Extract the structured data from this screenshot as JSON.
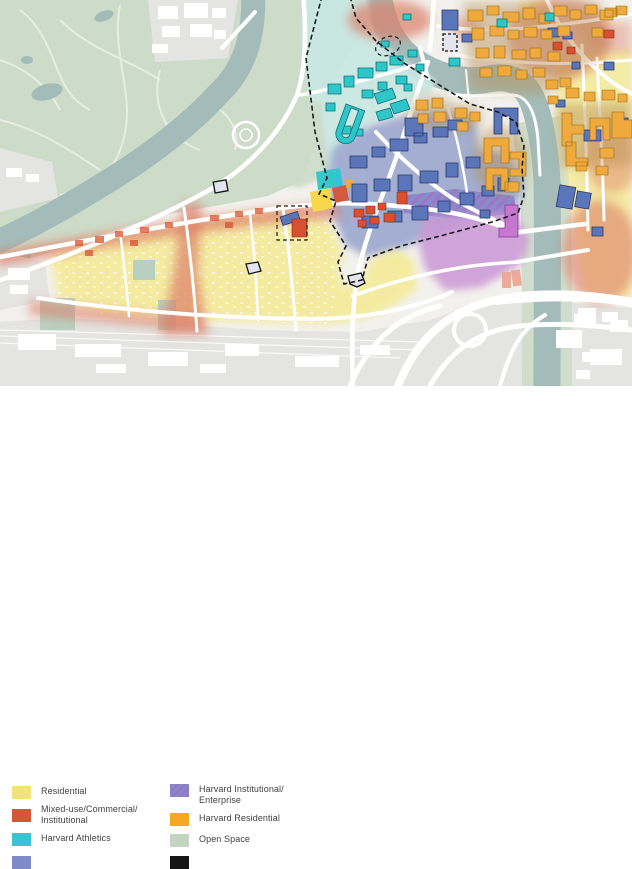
{
  "legend": {
    "columns": [
      {
        "items": [
          {
            "line1": "Residential",
            "line2": "",
            "color": "#f2e27d"
          },
          {
            "line1": "Mixed-use/Commercial/",
            "line2": "Institutional",
            "color": "#d5573b"
          },
          {
            "line1": "Harvard Athletics",
            "line2": "",
            "color": "#3bc3cf"
          },
          {
            "line1": "",
            "line2": "",
            "color": "#7d8cc7"
          }
        ]
      },
      {
        "items": [
          {
            "line1": "Harvard Institutional/",
            "line2": "Enterprise",
            "color": "#8289c9"
          },
          {
            "line1": "Harvard Residential",
            "line2": "",
            "color": "#f4a823"
          },
          {
            "line1": "Open Space",
            "line2": "",
            "color": "#c3d5c1"
          },
          {
            "line1": "",
            "line2": "",
            "color": "#161616"
          }
        ]
      }
    ]
  },
  "map": {
    "colors": {
      "base": "#f2f1ed",
      "park": "#cddcc9",
      "water": "#a3bcba",
      "athleticsZone": "#c9e8e3",
      "athleticsBldg": "#2ec6c9",
      "instZone": "#96a3cd",
      "instBldg": "#5b76b8",
      "instOutline": "#26386b",
      "enterpriseZone": "#cb97d6",
      "enterpriseBldg": "#c678cf",
      "enterpriseOutline": "#833b92",
      "hatchBase": "#8289cc",
      "hatchStripe": "#9f6fc2",
      "residential": "#f5eb9d",
      "residentialBright": "#f8d84a",
      "mixeduse": "#dd7f68",
      "mixeduseBldg": "#d8502f",
      "harvardRes": "#f0a93c",
      "harvardResShade": "#b78e52",
      "orangeOutline": "#8a6a1a",
      "redOutline": "#7e2a18",
      "tealOutline": "#0f6f74",
      "road": "#ffffff",
      "gray": "#e4e4e2",
      "parcelFill": "#e2e5ee",
      "salmon": "#e9a491",
      "boundary": "#1a1a1a"
    }
  }
}
